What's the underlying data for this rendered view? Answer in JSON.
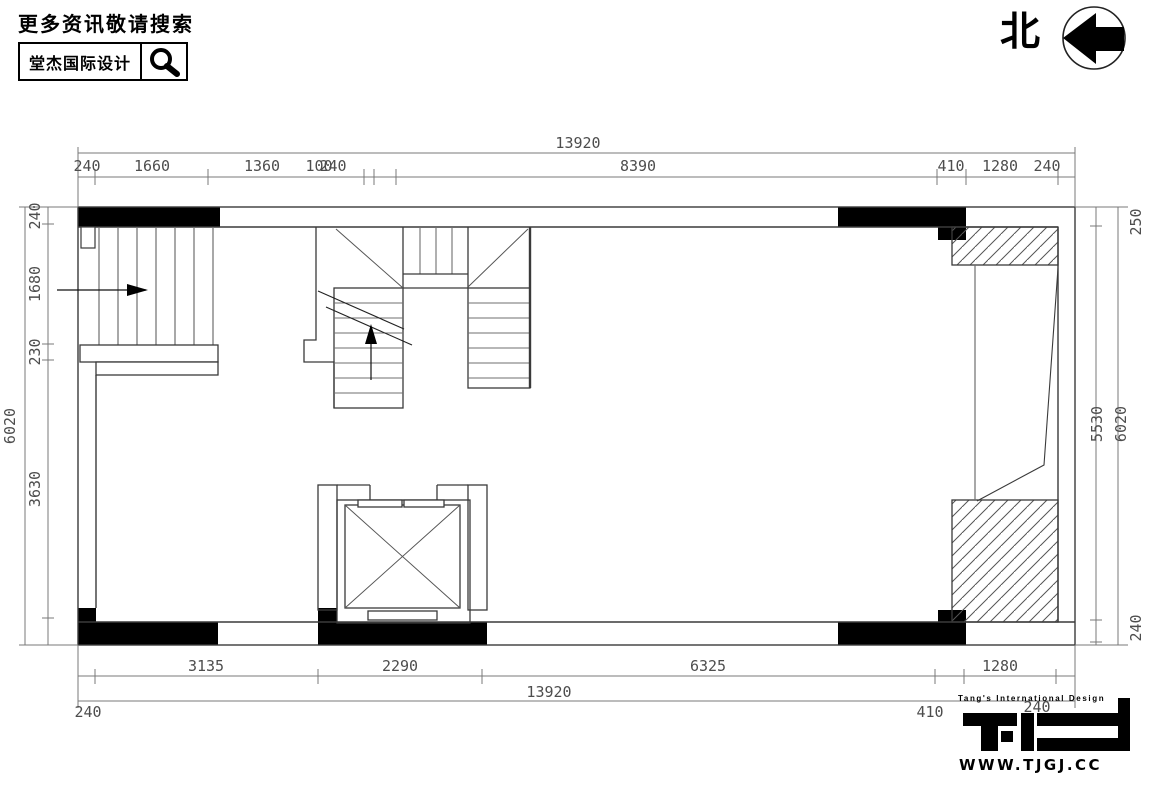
{
  "header": {
    "promo_text": "更多资讯敬请搜索",
    "brand_name": "堂杰国际设计",
    "north_label": "北"
  },
  "footer_logo": {
    "tagline": "Tang's International Design",
    "website": "WWW.TJGJ.CC"
  },
  "floor_plan": {
    "dimensions": {
      "top": {
        "overall": "13920",
        "chain": [
          "240",
          "1660",
          "1360",
          "100",
          "240",
          "8390",
          "410",
          "1280",
          "240"
        ]
      },
      "bottom": {
        "overall": "13920",
        "chain": [
          "240",
          "3135",
          "2290",
          "6325",
          "410",
          "1280",
          "240"
        ]
      },
      "left": {
        "overall": "6020",
        "chain": [
          "240",
          "1680",
          "230",
          "3630"
        ]
      },
      "right": {
        "overall": "6020",
        "chain": [
          "250",
          "5530",
          "240"
        ]
      }
    },
    "colors": {
      "wall_fill": "#000000",
      "line": "#3a3a3a",
      "dimension": "#4d4d4d"
    }
  }
}
